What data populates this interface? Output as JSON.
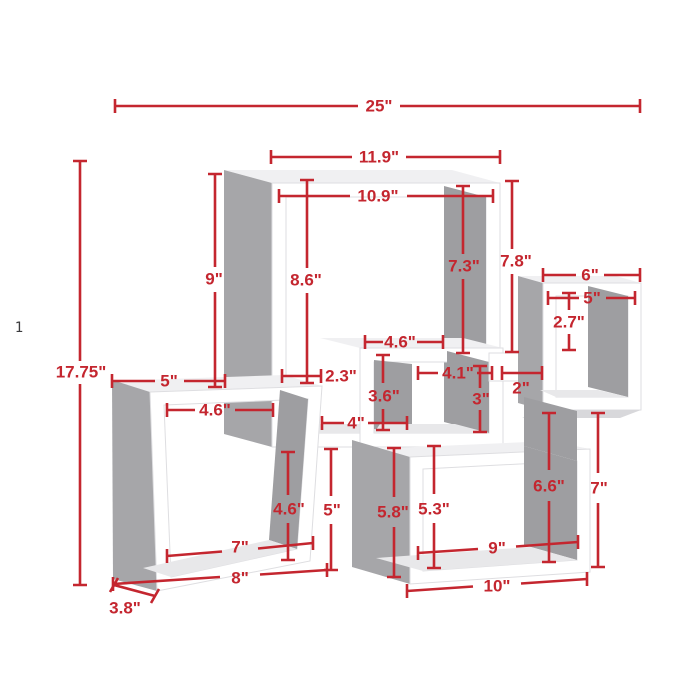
{
  "figure": {
    "kind": "product-dimension-diagram",
    "subject": "intersecting cubes wall shelf",
    "background": "#ffffff",
    "dimension_color": "#c4262f",
    "shelf_frame_color": "#ffffff",
    "shelf_side_color": "#a6a6a9"
  },
  "stray_text": "1",
  "dims": {
    "overall": {
      "width": "25\"",
      "height": "17.75\"",
      "depth": "3.8\""
    },
    "top_cube": {
      "outer_width": "11.9\"",
      "inner_width": "10.9\"",
      "left_height": "9\"",
      "inner_height": "8.6\"",
      "inner_right_height": "7.3\"",
      "right_height": "7.8\""
    },
    "right_cube": {
      "width": "6\"",
      "inner_width": "5\"",
      "inner_top_height": "2.7\"",
      "lower_inner_height": "6.6\"",
      "lower_height": "7\""
    },
    "middle_cube": {
      "shelf_width": "4.6\"",
      "inner_width": "4.1\"",
      "inner_height": "3.6\"",
      "bottom_width": "4\"",
      "gap_width": "2\"",
      "right_inner_height": "3\"",
      "post_offset": "2.3\""
    },
    "left_cube": {
      "top_width": "5\"",
      "inner_top_width": "4.6\"",
      "inner_upper_height": "4.6\"",
      "inner_height": "5\"",
      "inner_width": "7\"",
      "width": "8\""
    },
    "bottom_cube": {
      "height": "5.8\"",
      "inner_height": "5.3\"",
      "inner_width": "9\"",
      "width": "10\""
    }
  }
}
